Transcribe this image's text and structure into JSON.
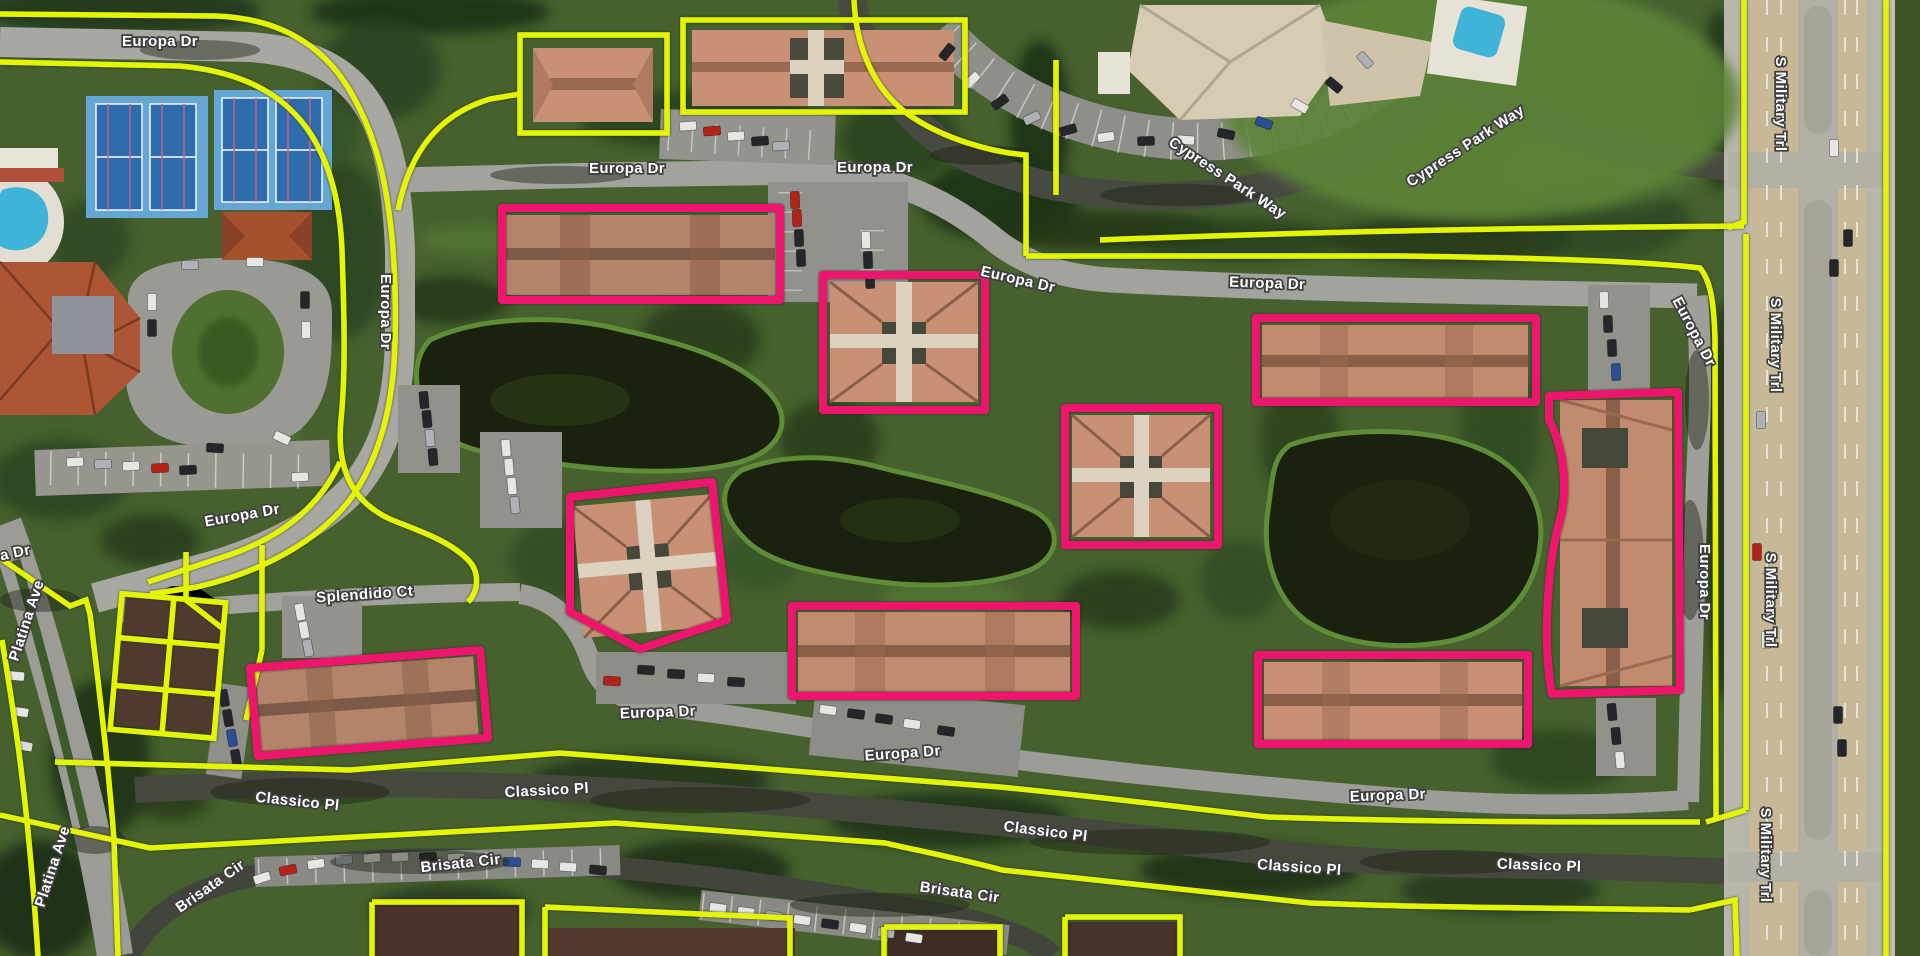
{
  "map": {
    "view": "aerial-satellite-with-parcel-overlay",
    "street_labels": {
      "europa_dr": "Europa Dr",
      "cypress_park_way": "Cypress Park Way",
      "s_military_trl": "S Military Trl",
      "splendido_ct": "Splendido Ct",
      "classico_pl": "Classico Pl",
      "brisata_cir": "Brisata Cir",
      "platina_ave": "Platina Ave"
    },
    "overlay": {
      "parcel_boundary_color": "#e3f604",
      "building_outline_color": "#ee156c",
      "building_outline_count": 9,
      "label_text_color": "#ffffff",
      "label_halo_color": "#3e3e3e"
    },
    "features": {
      "ponds": 3,
      "tennis_court_pads": 2,
      "swimming_pools": 2
    }
  }
}
